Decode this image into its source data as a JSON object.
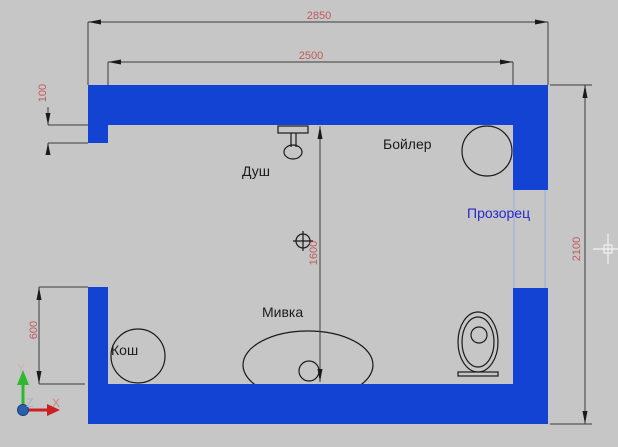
{
  "drawing": {
    "labels": {
      "shower": "Душ",
      "boiler": "Бойлер",
      "window": "Прозорец",
      "sink": "Мивка",
      "basket": "Кош"
    },
    "dimensions": {
      "outer_width": "2850",
      "inner_width": "2500",
      "outer_height": "2100",
      "inner_height": "1600",
      "left_wall_segment": "600",
      "wall_step": "100"
    },
    "ucs": {
      "x_label": "X",
      "y_label": "Y",
      "z_label": "Z"
    },
    "colors": {
      "background": "#c6c6c6",
      "wall": "#1243d2",
      "dimension_line": "#3c3c3c",
      "dimension_text": "#c05a5a",
      "window_label_text": "#2828cd",
      "window_glass_line": "#a9b3d6",
      "fixture_outline": "#1a1a1a",
      "axis_x_arrow": "#cc2020",
      "axis_y_arrow": "#2db82d",
      "axis_origin_ball": "#2a5fae",
      "crosshair": "#f2f2f2"
    }
  }
}
